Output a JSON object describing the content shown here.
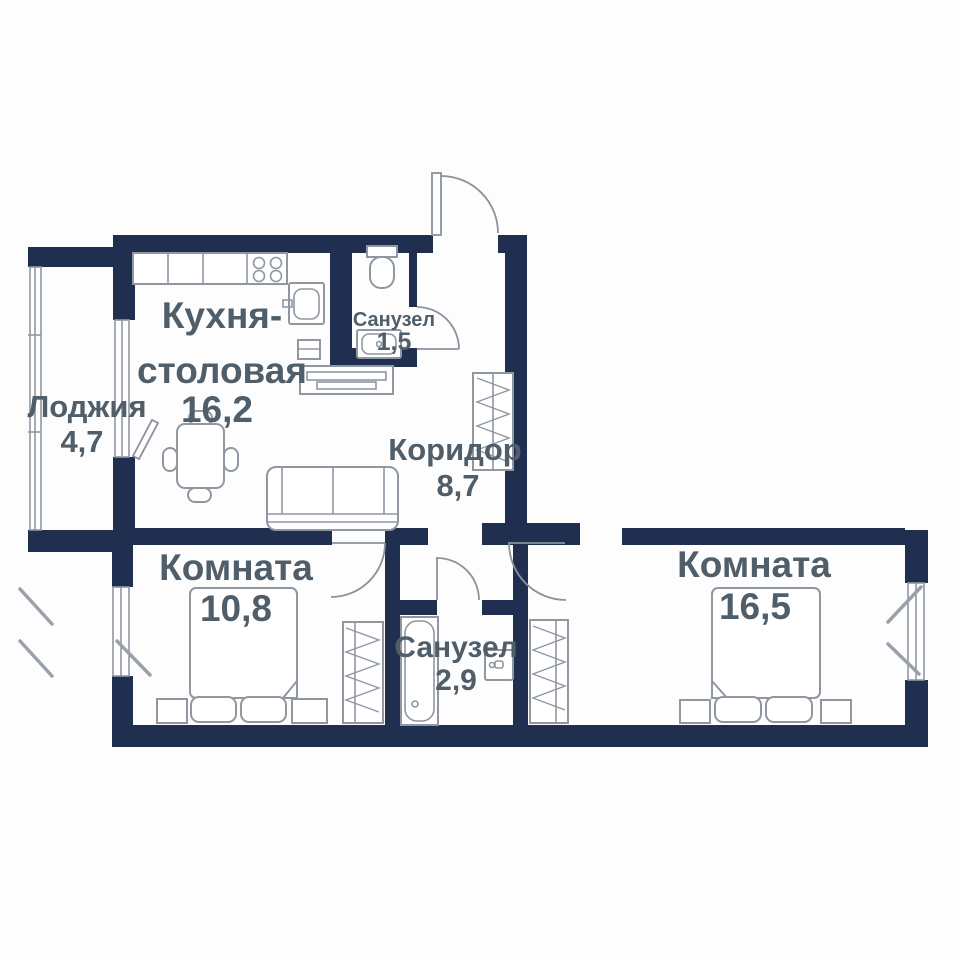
{
  "plan": {
    "type": "apartment-floor-plan",
    "rooms": {
      "kitchen": {
        "name_line1": "Кухня-",
        "name_line2": "столовая",
        "area": "16,2"
      },
      "loggia": {
        "name": "Лоджия",
        "area": "4,7"
      },
      "bathroom_small": {
        "name": "Санузел",
        "area": "1,5"
      },
      "corridor": {
        "name": "Коридор",
        "area": "8,7"
      },
      "bedroom_1": {
        "name": "Комната",
        "area": "10,8"
      },
      "bathroom_main": {
        "name": "Санузел",
        "area": "2,9"
      },
      "bedroom_2": {
        "name": "Комната",
        "area": "16,5"
      }
    },
    "colors": {
      "wall": "#202e50",
      "furniture_line": "#9097a1",
      "label_text": "#4f5e69",
      "background": "#ffffff"
    }
  }
}
